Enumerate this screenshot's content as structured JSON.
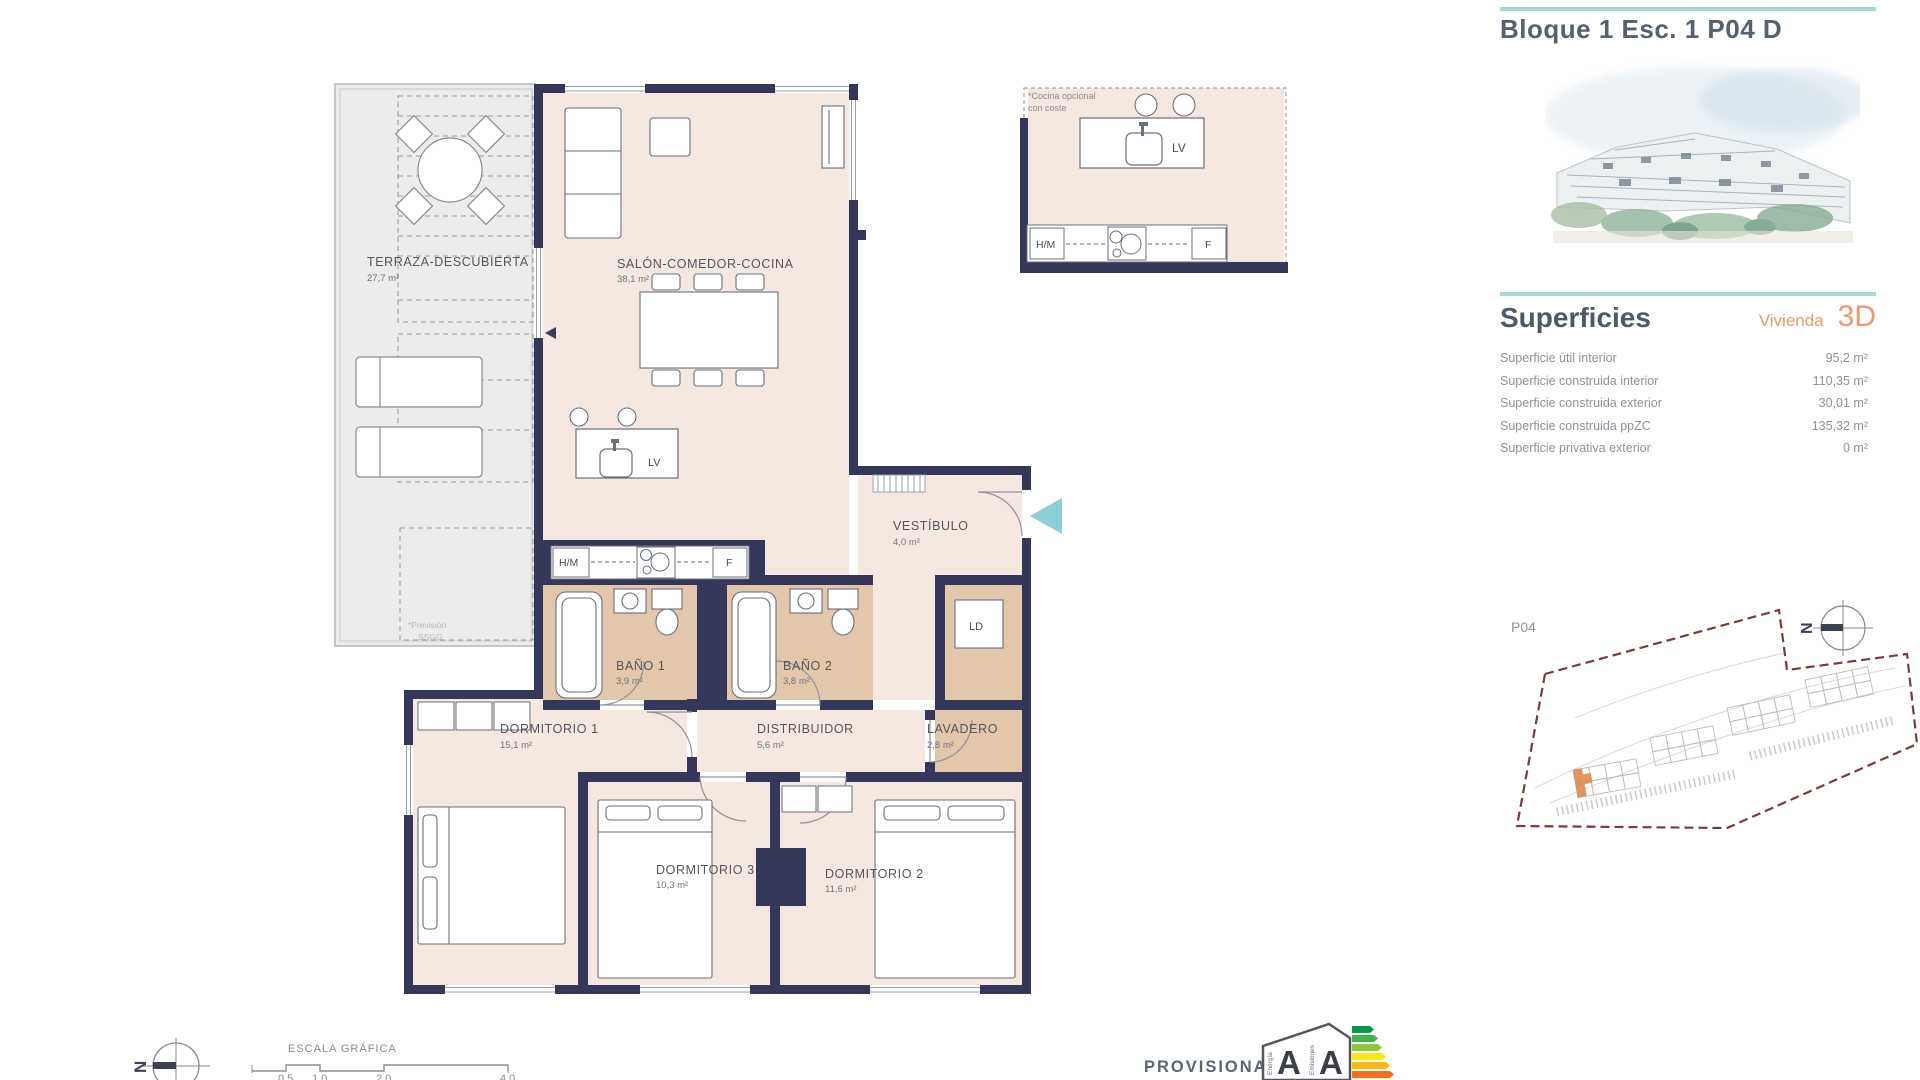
{
  "header": {
    "title": "Bloque 1 Esc. 1 P04 D"
  },
  "superficies": {
    "heading": "Superficies",
    "dwelling_label": "Vivienda",
    "dwelling_type": "3D",
    "rows": [
      {
        "label": "Superficie útil interior",
        "value": "95,2 m²"
      },
      {
        "label": "Superficie construida interior",
        "value": "110,35 m²"
      },
      {
        "label": "Superficie construida exterior",
        "value": "30,01 m²"
      },
      {
        "label": "Superficie construida ppZC",
        "value": "135,32 m²"
      },
      {
        "label": "Superficie privativa exterior",
        "value": "0 m²"
      }
    ]
  },
  "siteplan": {
    "floor_label": "P04",
    "north_label": "N"
  },
  "plan": {
    "rooms": {
      "terraza": {
        "name": "TERRAZA-DESCUBIERTA",
        "area": "27,7 m²"
      },
      "salon": {
        "name": "SALÓN-COMEDOR-COCINA",
        "area": "38,1 m²"
      },
      "vestibulo": {
        "name": "VESTÍBULO",
        "area": "4,0 m²"
      },
      "bano1": {
        "name": "BAÑO 1",
        "area": "3,9 m²"
      },
      "bano2": {
        "name": "BAÑO 2",
        "area": "3,8 m²"
      },
      "dormitorio1": {
        "name": "DORMITORIO 1",
        "area": "15,1 m²"
      },
      "distribuidor": {
        "name": "DISTRIBUIDOR",
        "area": "5,6 m²"
      },
      "lavadero": {
        "name": "LAVADERO",
        "area": "2,8 m²"
      },
      "dormitorio3": {
        "name": "DORMITORIO 3",
        "area": "10,3 m²"
      },
      "dormitorio2": {
        "name": "DORMITORIO 2",
        "area": "11,6 m²"
      }
    },
    "fixtures": {
      "dishwasher": "LV",
      "hob": "H/M",
      "fridge": "F",
      "laundry": "LD"
    },
    "terrace_note": {
      "line1": "*Previsión",
      "line2": "SSGG"
    },
    "kitchen_detail_note": {
      "line1": "*Cocina opcional",
      "line2": "con coste"
    }
  },
  "footer": {
    "scale_heading": "ESCALA GRÁFICA",
    "scale_ticks": [
      "0,5",
      "1,0",
      "2,0",
      "4,0"
    ],
    "provisional": "PROVISIONAL",
    "north_label": "N",
    "energy": {
      "energy_letter": "A",
      "emissions_letter": "A",
      "energy_caption": "Energía",
      "emissions_caption": "Emisiones"
    }
  },
  "colors": {
    "accent_teal": "#a9d6d6",
    "accent_orange": "#e99a70",
    "wall": "#343759",
    "floor": "#f5e8e0",
    "wet_floor": "#e2c7ab",
    "terrace_floor": "#ececec",
    "site_boundary": "#7c3a3a",
    "entry_arrow": "#8ccfd6"
  }
}
